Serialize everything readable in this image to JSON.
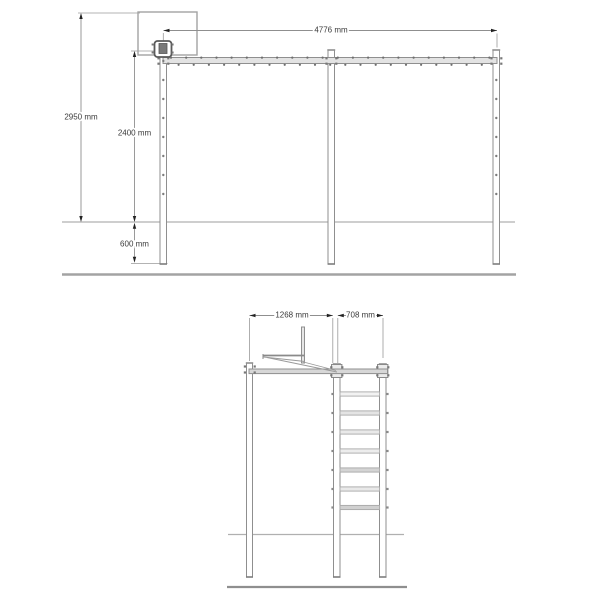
{
  "colors": {
    "background": "#ffffff",
    "structure_stroke": "#8f8f8f",
    "backboard_stroke": "#a3a3a3",
    "beam_fill": "#e3e3e3",
    "side_beam_fill": "#d7d7d7",
    "post_fill": "#ffffff",
    "ext_line": "#9a9a9a",
    "dim_line": "#8f8f8f",
    "dim_text": "#3a3a3a",
    "arrow": "#222222",
    "bolt": "#6e6e6e",
    "ground_line": "#b0b0b0",
    "base_line": "#a3a3a3",
    "cap": "#7d7d7d"
  },
  "views": {
    "front": {
      "title": "front-elevation-monkey-bar-with-basketball-hoop",
      "dims": [
        {
          "type": "v",
          "label": "2950 mm",
          "x": 81,
          "lineY1": 16,
          "lineY2": 219,
          "tip1": 13,
          "tip2": 222,
          "labelY": 117
        },
        {
          "type": "v",
          "label": "2400 mm",
          "x": 134.5,
          "lineY1": 54,
          "lineY2": 219,
          "tip1": 51,
          "tip2": 222,
          "labelY": 133
        },
        {
          "type": "v",
          "label": "600 mm",
          "x": 134.5,
          "lineY1": 225.5,
          "lineY2": 260,
          "tip1": 222.8,
          "tip2": 262.8,
          "labelY": 244
        },
        {
          "type": "h",
          "label": "4776 mm",
          "y": 30.5,
          "x1": 163.5,
          "x2": 497,
          "labelX": 331
        }
      ],
      "shapes": [
        {
          "t": "line",
          "n": "extension-line",
          "x1": 78,
          "y1": 13,
          "x2": 140,
          "y2": 13,
          "w": 0.8,
          "c": "ext"
        },
        {
          "t": "line",
          "n": "extension-line",
          "x1": 131,
          "y1": 51,
          "x2": 160,
          "y2": 51,
          "w": 0.8,
          "c": "ext"
        },
        {
          "t": "line",
          "n": "extension-line",
          "x1": 131,
          "y1": 263.5,
          "x2": 167.5,
          "y2": 263.5,
          "w": 0.8,
          "c": "ext"
        },
        {
          "t": "line",
          "n": "extension-line",
          "x1": 497,
          "y1": 33.5,
          "x2": 497,
          "y2": 47.5,
          "w": 0.8,
          "c": "ext"
        },
        {
          "t": "line",
          "n": "extension-line",
          "x1": 163.3,
          "y1": 33,
          "x2": 163.3,
          "y2": 41,
          "w": 0.8,
          "c": "ext"
        },
        {
          "t": "rect",
          "n": "basketball-backboard",
          "x": 138,
          "y": 12,
          "w": 59,
          "h": 43,
          "sw": 1.4,
          "sc": "#a3a3a3"
        },
        {
          "t": "line",
          "n": "ground-line",
          "x1": 62,
          "y1": 222,
          "x2": 515,
          "y2": 222,
          "w": 1.2,
          "c": "#b0b0b0"
        },
        {
          "t": "line",
          "n": "base-line",
          "x1": 62,
          "y1": 274.5,
          "x2": 516,
          "y2": 274.5,
          "w": 2.6,
          "c": "#a3a3a3"
        },
        {
          "t": "rect",
          "n": "post-left",
          "x": 160,
          "y": 44,
          "w": 6.5,
          "h": 220,
          "sw": 1,
          "sc": "#8f8f8f",
          "fc": "#ffffff"
        },
        {
          "t": "rect",
          "n": "post-middle",
          "x": 328,
          "y": 50,
          "w": 6.5,
          "h": 214,
          "sw": 1,
          "sc": "#8f8f8f",
          "fc": "#ffffff"
        },
        {
          "t": "rect",
          "n": "post-right",
          "x": 493,
          "y": 50,
          "w": 6.5,
          "h": 214,
          "sw": 1,
          "sc": "#8f8f8f",
          "fc": "#ffffff"
        },
        {
          "t": "line",
          "n": "post-top-cap",
          "x1": 327.3,
          "y1": 50,
          "x2": 335.2,
          "y2": 50,
          "w": 1.6,
          "c": "#8f8f8f"
        },
        {
          "t": "line",
          "n": "post-top-cap",
          "x1": 492.3,
          "y1": 50,
          "x2": 500.2,
          "y2": 50,
          "w": 1.6,
          "c": "#8f8f8f"
        },
        {
          "t": "line",
          "n": "post-bottom-cap",
          "x1": 159.6,
          "y1": 264,
          "x2": 167,
          "y2": 264,
          "w": 1.6,
          "c": "#7d7d7d"
        },
        {
          "t": "line",
          "n": "post-bottom-cap",
          "x1": 327.6,
          "y1": 264,
          "x2": 335,
          "y2": 264,
          "w": 1.6,
          "c": "#7d7d7d"
        },
        {
          "t": "line",
          "n": "post-bottom-cap",
          "x1": 492.6,
          "y1": 264,
          "x2": 500,
          "y2": 264,
          "w": 1.6,
          "c": "#7d7d7d"
        },
        {
          "t": "rect",
          "n": "monkey-bar-rail",
          "x": 163,
          "y": 57.5,
          "w": 334,
          "h": 6,
          "sw": 1,
          "sc": "#8f8f8f",
          "fc": "#e3e3e3"
        },
        {
          "t": "sq",
          "n": "junction-bolt",
          "x": 157.4,
          "y": 57.2,
          "s": 2.2
        },
        {
          "t": "sq",
          "n": "junction-bolt",
          "x": 157.4,
          "y": 62.6,
          "s": 2.2
        },
        {
          "t": "sq",
          "n": "junction-bolt",
          "x": 167.2,
          "y": 57.2,
          "s": 2.2
        },
        {
          "t": "sq",
          "n": "junction-bolt",
          "x": 167.2,
          "y": 62.6,
          "s": 2.2
        },
        {
          "t": "sq",
          "n": "junction-bolt",
          "x": 325.4,
          "y": 57.2,
          "s": 2.2
        },
        {
          "t": "sq",
          "n": "junction-bolt",
          "x": 325.4,
          "y": 62.6,
          "s": 2.2
        },
        {
          "t": "sq",
          "n": "junction-bolt",
          "x": 335.2,
          "y": 57.2,
          "s": 2.2
        },
        {
          "t": "sq",
          "n": "junction-bolt",
          "x": 335.2,
          "y": 62.6,
          "s": 2.2
        },
        {
          "t": "sq",
          "n": "junction-bolt",
          "x": 490.4,
          "y": 57.2,
          "s": 2.2
        },
        {
          "t": "sq",
          "n": "junction-bolt",
          "x": 490.4,
          "y": 62.6,
          "s": 2.2
        },
        {
          "t": "sq",
          "n": "junction-bolt",
          "x": 500.2,
          "y": 57.2,
          "s": 2.2
        },
        {
          "t": "sq",
          "n": "junction-bolt",
          "x": 500.2,
          "y": 62.6,
          "s": 2.2
        },
        {
          "t": "rect",
          "n": "hoop-bracket",
          "x": 154.5,
          "y": 41,
          "w": 17,
          "h": 16,
          "rx": 3,
          "sw": 1.8,
          "sc": "#5a5a5a",
          "fc": "#ffffff"
        },
        {
          "t": "rect",
          "n": "hoop-ring-mount",
          "x": 159,
          "y": 43.5,
          "w": 8,
          "h": 10,
          "sw": 0.8,
          "sc": "#555555",
          "fc": "#787878"
        },
        {
          "t": "sq",
          "n": "hoop-bolt",
          "x": 151.6,
          "y": 43.5,
          "s": 2
        },
        {
          "t": "sq",
          "n": "hoop-bolt",
          "x": 151.6,
          "y": 51.5,
          "s": 2
        },
        {
          "t": "sq",
          "n": "hoop-bolt",
          "x": 171.6,
          "y": 43.5,
          "s": 2
        },
        {
          "t": "sq",
          "n": "hoop-bolt",
          "x": 171.6,
          "y": 51.5,
          "s": 2
        }
      ],
      "rail_bolt_row": {
        "x1": 171,
        "x2": 490,
        "step": 7.58,
        "yTop": 57.6,
        "yBot": 64.8,
        "r": 1.1
      },
      "post_hole_columns": [
        {
          "x": 163.3,
          "ys": [
            61,
            80,
            99,
            118,
            137,
            156,
            175,
            194
          ]
        },
        {
          "x": 496.3,
          "ys": [
            80,
            99,
            118,
            137,
            156,
            175,
            194
          ]
        }
      ]
    },
    "side": {
      "title": "side-elevation-with-ladder",
      "dims": [
        {
          "type": "h",
          "label": "1268 mm",
          "y": 315.5,
          "x1": 249.5,
          "x2": 332.8,
          "labelX": 292
        },
        {
          "type": "h",
          "label": "708 mm",
          "y": 315.5,
          "x1": 337.8,
          "x2": 383,
          "labelX": 360.5
        }
      ],
      "shapes": [
        {
          "t": "line",
          "n": "extension-line",
          "x1": 249.5,
          "y1": 318,
          "x2": 249.5,
          "y2": 361,
          "w": 0.8,
          "c": "ext"
        },
        {
          "t": "line",
          "n": "extension-line",
          "x1": 332.8,
          "y1": 318,
          "x2": 332.8,
          "y2": 363,
          "w": 0.8,
          "c": "ext"
        },
        {
          "t": "line",
          "n": "extension-line",
          "x1": 337.8,
          "y1": 318,
          "x2": 337.8,
          "y2": 363,
          "w": 0.8,
          "c": "ext"
        },
        {
          "t": "line",
          "n": "extension-line",
          "x1": 383,
          "y1": 318,
          "x2": 383,
          "y2": 358,
          "w": 0.8,
          "c": "ext"
        },
        {
          "t": "line",
          "n": "ground-line",
          "x1": 228,
          "y1": 534.5,
          "x2": 404,
          "y2": 534.5,
          "w": 1.2,
          "c": "#b0b0b0"
        },
        {
          "t": "line",
          "n": "base-line",
          "x1": 227,
          "y1": 587,
          "x2": 407,
          "y2": 587,
          "w": 2.2,
          "c": "#8f8f8f"
        },
        {
          "t": "rect",
          "n": "post-front",
          "x": 246.5,
          "y": 363,
          "w": 6,
          "h": 214,
          "sw": 1,
          "sc": "#8f8f8f",
          "fc": "#ffffff"
        },
        {
          "t": "rect",
          "n": "ladder-rail-left",
          "x": 333.5,
          "y": 364,
          "w": 6.5,
          "h": 213,
          "sw": 1,
          "sc": "#8f8f8f",
          "fc": "#ffffff"
        },
        {
          "t": "rect",
          "n": "ladder-rail-right",
          "x": 379.5,
          "y": 364,
          "w": 6.5,
          "h": 213,
          "sw": 1,
          "sc": "#8f8f8f",
          "fc": "#ffffff"
        },
        {
          "t": "line",
          "n": "post-top-cap",
          "x1": 245.8,
          "y1": 363,
          "x2": 253.2,
          "y2": 363,
          "w": 1.6,
          "c": "#8f8f8f"
        },
        {
          "t": "line",
          "n": "post-top-cap",
          "x1": 332.8,
          "y1": 364,
          "x2": 340.8,
          "y2": 364,
          "w": 1.6,
          "c": "#8f8f8f"
        },
        {
          "t": "line",
          "n": "post-top-cap",
          "x1": 378.8,
          "y1": 364,
          "x2": 386.8,
          "y2": 364,
          "w": 1.6,
          "c": "#8f8f8f"
        },
        {
          "t": "line",
          "n": "post-bottom-cap",
          "x1": 246,
          "y1": 577,
          "x2": 253,
          "y2": 577,
          "w": 1.6,
          "c": "#7d7d7d"
        },
        {
          "t": "line",
          "n": "post-bottom-cap",
          "x1": 333,
          "y1": 577,
          "x2": 340.5,
          "y2": 577,
          "w": 1.6,
          "c": "#7d7d7d"
        },
        {
          "t": "line",
          "n": "post-bottom-cap",
          "x1": 379,
          "y1": 577,
          "x2": 386.5,
          "y2": 577,
          "w": 1.6,
          "c": "#7d7d7d"
        },
        {
          "t": "rect",
          "n": "rail-bracket",
          "x": 331.5,
          "y": 364.5,
          "w": 10.4,
          "h": 13,
          "sw": 1,
          "sc": "#8a8a8a",
          "fc": "#ececec"
        },
        {
          "t": "rect",
          "n": "rail-bracket",
          "x": 377.5,
          "y": 364.5,
          "w": 10.4,
          "h": 13,
          "sw": 1,
          "sc": "#8a8a8a",
          "fc": "#ececec"
        },
        {
          "t": "rect",
          "n": "monkey-bar-rail-side",
          "x": 249,
          "y": 369,
          "w": 138.5,
          "h": 4.6,
          "sw": 1,
          "sc": "#8f8f8f",
          "fc": "#d7d7d7"
        },
        {
          "t": "sq",
          "n": "junction-bolt",
          "x": 243.8,
          "y": 365.4,
          "s": 2.2
        },
        {
          "t": "sq",
          "n": "junction-bolt",
          "x": 253.6,
          "y": 365.4,
          "s": 2.2
        },
        {
          "t": "sq",
          "n": "junction-bolt",
          "x": 243.8,
          "y": 371.4,
          "s": 2.2
        },
        {
          "t": "sq",
          "n": "junction-bolt",
          "x": 253.6,
          "y": 371.4,
          "s": 2.2
        },
        {
          "t": "sq",
          "n": "junction-bolt",
          "x": 330.2,
          "y": 366.2,
          "s": 2.2
        },
        {
          "t": "sq",
          "n": "junction-bolt",
          "x": 341.2,
          "y": 366.2,
          "s": 2.2
        },
        {
          "t": "sq",
          "n": "junction-bolt",
          "x": 330.2,
          "y": 374.2,
          "s": 2.2
        },
        {
          "t": "sq",
          "n": "junction-bolt",
          "x": 341.2,
          "y": 374.2,
          "s": 2.2
        },
        {
          "t": "sq",
          "n": "junction-bolt",
          "x": 376.2,
          "y": 366.2,
          "s": 2.2
        },
        {
          "t": "sq",
          "n": "junction-bolt",
          "x": 387.2,
          "y": 366.2,
          "s": 2.2
        },
        {
          "t": "sq",
          "n": "junction-bolt",
          "x": 376.2,
          "y": 374.2,
          "s": 2.2
        },
        {
          "t": "sq",
          "n": "junction-bolt",
          "x": 387.2,
          "y": 374.2,
          "s": 2.2
        },
        {
          "t": "rect",
          "n": "backboard-edge",
          "x": 301.5,
          "y": 327,
          "w": 3,
          "h": 36,
          "sw": 1,
          "sc": "#8f8f8f",
          "fc": "#e6e6e6"
        },
        {
          "t": "line",
          "n": "hoop-rim-side",
          "x1": 263,
          "y1": 355.5,
          "x2": 304,
          "y2": 355.5,
          "w": 1.8,
          "c": "#8a8a8a"
        },
        {
          "t": "line",
          "n": "hoop-rim-edge",
          "x1": 263,
          "y1": 354,
          "x2": 263,
          "y2": 359,
          "w": 1,
          "c": "#8a8a8a"
        },
        {
          "t": "line",
          "n": "rim-underside",
          "x1": 263.5,
          "y1": 357,
          "x2": 305,
          "y2": 361.5,
          "w": 0.9,
          "c": "#9a9a9a"
        },
        {
          "t": "line",
          "n": "diagonal-brace",
          "x1": 267,
          "y1": 357.5,
          "x2": 337,
          "y2": 372,
          "w": 0.9,
          "c": "#9a9a9a"
        },
        {
          "t": "line",
          "n": "diagonal-brace",
          "x1": 303.5,
          "y1": 362,
          "x2": 336,
          "y2": 370.5,
          "w": 0.9,
          "c": "#9a9a9a"
        }
      ],
      "ladder": {
        "x": 340,
        "w": 39.6,
        "h": 4.2,
        "rung_ys": [
          394,
          413,
          432,
          451,
          470,
          489,
          507.5
        ],
        "rung_fills": [
          "#f2f2f2",
          "#e4e4e4",
          "#e9e9e9",
          "#ededed",
          "#d4d4d4",
          "#e9e9e9",
          "#d0d0d0"
        ],
        "bolt_x_left": 331.4,
        "bolt_x_right": 386.4,
        "bolt_size": 2.2
      }
    }
  }
}
